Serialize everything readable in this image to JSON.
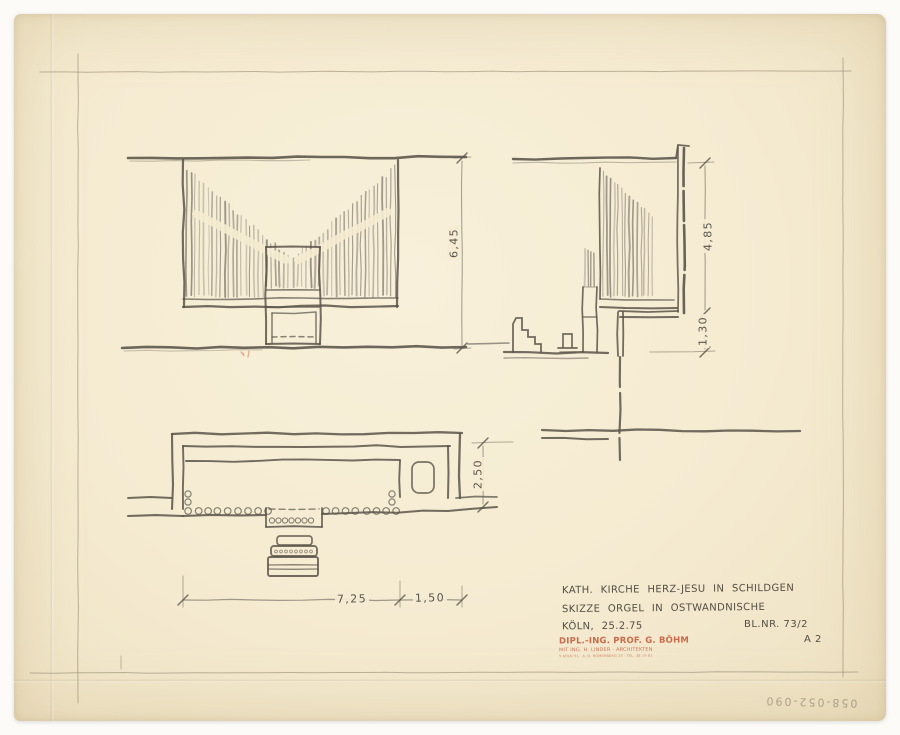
{
  "sheet": {
    "colors": {
      "background": "#fcfbf8",
      "paper": "#f5ebd1",
      "pencil": "#5a5449",
      "pencil_light": "#8d8268",
      "pipe_gray": "#6e675c",
      "stamp_red": "#c55a3a"
    },
    "title_block": {
      "line1": "KATH. KIRCHE HERZ-JESU IN SCHILDGEN",
      "line2": "SKIZZE ORGEL IN OSTWANDNISCHE",
      "line3": "KÖLN, 25.2.75",
      "sheet_number": "BL.NR. 73/2",
      "format": "A 2"
    },
    "architect_stamp": {
      "line1": "DIPL.-ING. PROF. G. BÖHM",
      "line2": "MIT ING. H. LINDER · ARCHITEKTEN",
      "line3": "5 KÖLN 51 · A. D. RÖMERBERG 25 · TEL. 38 19 81"
    },
    "dimensions": {
      "elevation_height": "6,45",
      "section_upper_height": "4,85",
      "section_parapet_height": "1,30",
      "plan_depth": "2,50",
      "plan_main_width": "7,25",
      "plan_side_width": "1,50"
    },
    "archive_number": "058-052-090"
  }
}
